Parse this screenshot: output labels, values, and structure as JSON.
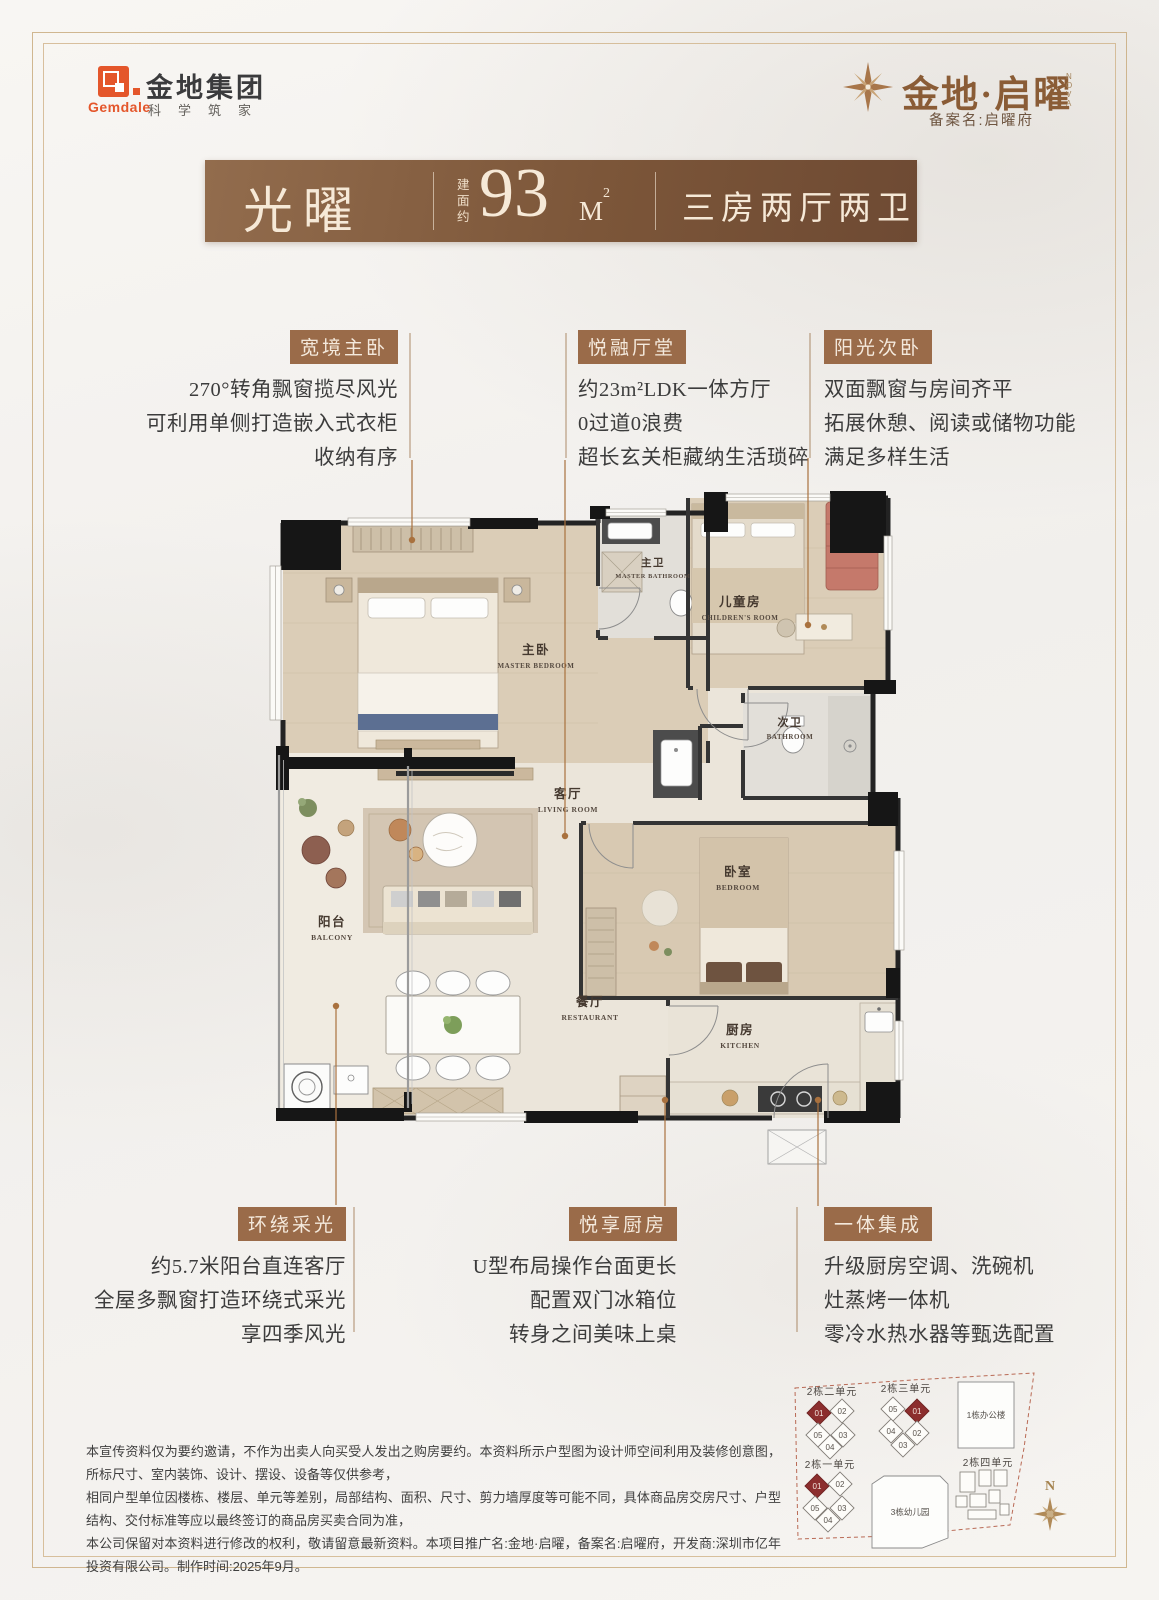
{
  "header": {
    "gemdale": {
      "name_cn": "金地集团",
      "name_en": "Gemdale",
      "slogan": "科学筑家"
    },
    "project": {
      "name": "金地·启曜",
      "name_sub": "NOVA",
      "record": "备案名:启曜府"
    }
  },
  "banner": {
    "unit_name": "光曜",
    "area_label": "建面约",
    "area_value": "93",
    "area_unit": "M",
    "area_sup": "2",
    "layout": "三房两厅两卫"
  },
  "features_top": [
    {
      "title": "宽境主卧",
      "lines": [
        "270°转角飘窗揽尽风光",
        "可利用单侧打造嵌入式衣柜",
        "收纳有序"
      ]
    },
    {
      "title": "悦融厅堂",
      "lines": [
        "约23m²LDK一体方厅",
        "0过道0浪费",
        "超长玄关柜藏纳生活琐碎"
      ]
    },
    {
      "title": "阳光次卧",
      "lines": [
        "双面飘窗与房间齐平",
        "拓展休憩、阅读或储物功能",
        "满足多样生活"
      ]
    }
  ],
  "features_bottom": [
    {
      "title": "环绕采光",
      "lines": [
        "约5.7米阳台直连客厅",
        "全屋多飘窗打造环绕式采光",
        "享四季风光"
      ]
    },
    {
      "title": "悦享厨房",
      "lines": [
        "U型布局操作台面更长",
        "配置双门冰箱位",
        "转身之间美味上桌"
      ]
    },
    {
      "title": "一体集成",
      "lines": [
        "升级厨房空调、洗碗机",
        "灶蒸烤一体机",
        "零冷水热水器等甄选配置"
      ]
    }
  ],
  "floorplan": {
    "rooms": {
      "master_bath": {
        "zh": "主卫",
        "en": "MASTER BATHROOM"
      },
      "master_bed": {
        "zh": "主卧",
        "en": "MASTER BEDROOM"
      },
      "children": {
        "zh": "儿童房",
        "en": "CHILDREN'S ROOM"
      },
      "bath2": {
        "zh": "次卫",
        "en": "BATHROOM"
      },
      "living": {
        "zh": "客厅",
        "en": "LIVING ROOM"
      },
      "balcony": {
        "zh": "阳台",
        "en": "BALCONY"
      },
      "dining": {
        "zh": "餐厅",
        "en": "RESTAURANT"
      },
      "bedroom2": {
        "zh": "卧室",
        "en": "BEDROOM"
      },
      "kitchen": {
        "zh": "厨房",
        "en": "KITCHEN"
      }
    }
  },
  "disclaimer": {
    "line1": "本宣传资料仅为要约邀请，不作为出卖人向买受人发出之购房要约。本资料所示户型图为设计师空间利用及装修创意图，所标尺寸、室内装饰、设计、摆设、设备等仅供参考，",
    "line2": "相同户型单位因楼栋、楼层、单元等差别，局部结构、面积、尺寸、剪力墙厚度等可能不同，具体商品房交房尺寸、户型结构、交付标准等应以最终签订的商品房买卖合同为准，",
    "line3": "本公司保留对本资料进行修改的权利，敬请留意最新资料。本项目推广名:金地·启曜，备案名:启曜府，开发商:深圳市亿年投资有限公司。制作时间:2025年9月。"
  },
  "sitemap": {
    "cluster_a": {
      "label": "2栋二单元",
      "u1": "01",
      "u2": "02",
      "u3": "05",
      "u4": "03",
      "u5": "04"
    },
    "cluster_b": {
      "label": "2栋三单元",
      "u1": "05",
      "u2": "01",
      "u3": "04",
      "u4": "02",
      "u5": "03"
    },
    "cluster_c": {
      "label": "2栋一单元",
      "u1": "01",
      "u2": "02",
      "u3": "05",
      "u4": "03",
      "u5": "04"
    },
    "cluster_d": {
      "label": "2栋四单元"
    },
    "office": "1栋办公楼",
    "kindergarten": "3栋幼儿园",
    "compass": "N"
  },
  "colors": {
    "accent_badge": "#9a6b49",
    "banner_from": "#926c4d",
    "banner_to": "#6e4a33",
    "leader_line": "#a9713e",
    "highlight_unit": "#8c2e2e",
    "gemdale_orange": "#e4562b",
    "frame_gold": "#c9ab7f",
    "boundary_dash": "#b96a55"
  }
}
